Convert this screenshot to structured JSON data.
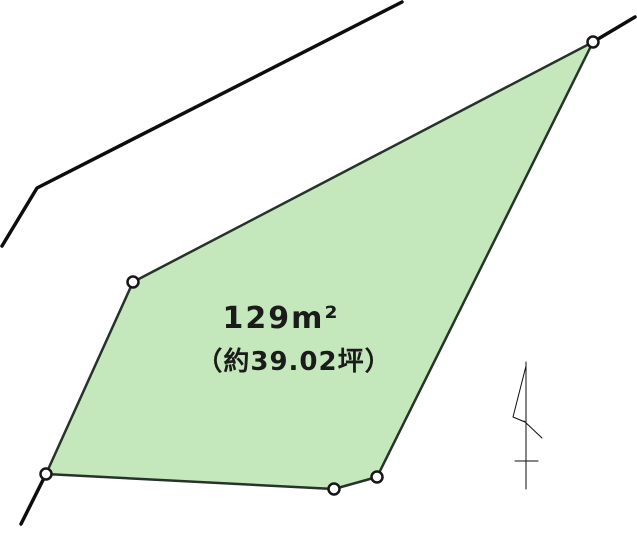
{
  "canvas": {
    "width": 637,
    "height": 539,
    "background": "#ffffff"
  },
  "parcel": {
    "description": "land-parcel-outline",
    "fill_color": "#c4e8bc",
    "outline_color": "#27332a",
    "outline_width": 2.5,
    "polygon_points": "593,42 133,282 46,474 334,489 377,477",
    "vertices": [
      {
        "x": 593,
        "y": 42
      },
      {
        "x": 133,
        "y": 282
      },
      {
        "x": 46,
        "y": 474
      },
      {
        "x": 334,
        "y": 489
      },
      {
        "x": 377,
        "y": 477
      }
    ],
    "marker": {
      "radius": 5.5,
      "fill": "#ffffff",
      "stroke": "#161616",
      "stroke_width": 2.5
    },
    "labels": {
      "area_m2": "129m²",
      "area_tsubo": "（約39.02坪）",
      "text_color": "#1b1b1b"
    },
    "label_pos": {
      "m2": {
        "x": 281,
        "y": 328
      },
      "tsubo": {
        "x": 294,
        "y": 370
      }
    }
  },
  "boundary_lines": {
    "color": "#0d0d0d",
    "width": 3.5,
    "road_polyline": "402,2 37,188 2,246",
    "extension_top_right": "593,42 635,17",
    "extension_bottom_left": "46,474 21,524"
  },
  "north_arrow": {
    "color": "#0d0d0d",
    "staff": "526,362 526,489",
    "pennant": "526,366 513,417 525,422",
    "tick": "524,421 542,438",
    "crossbar": "515,461 538,461"
  }
}
